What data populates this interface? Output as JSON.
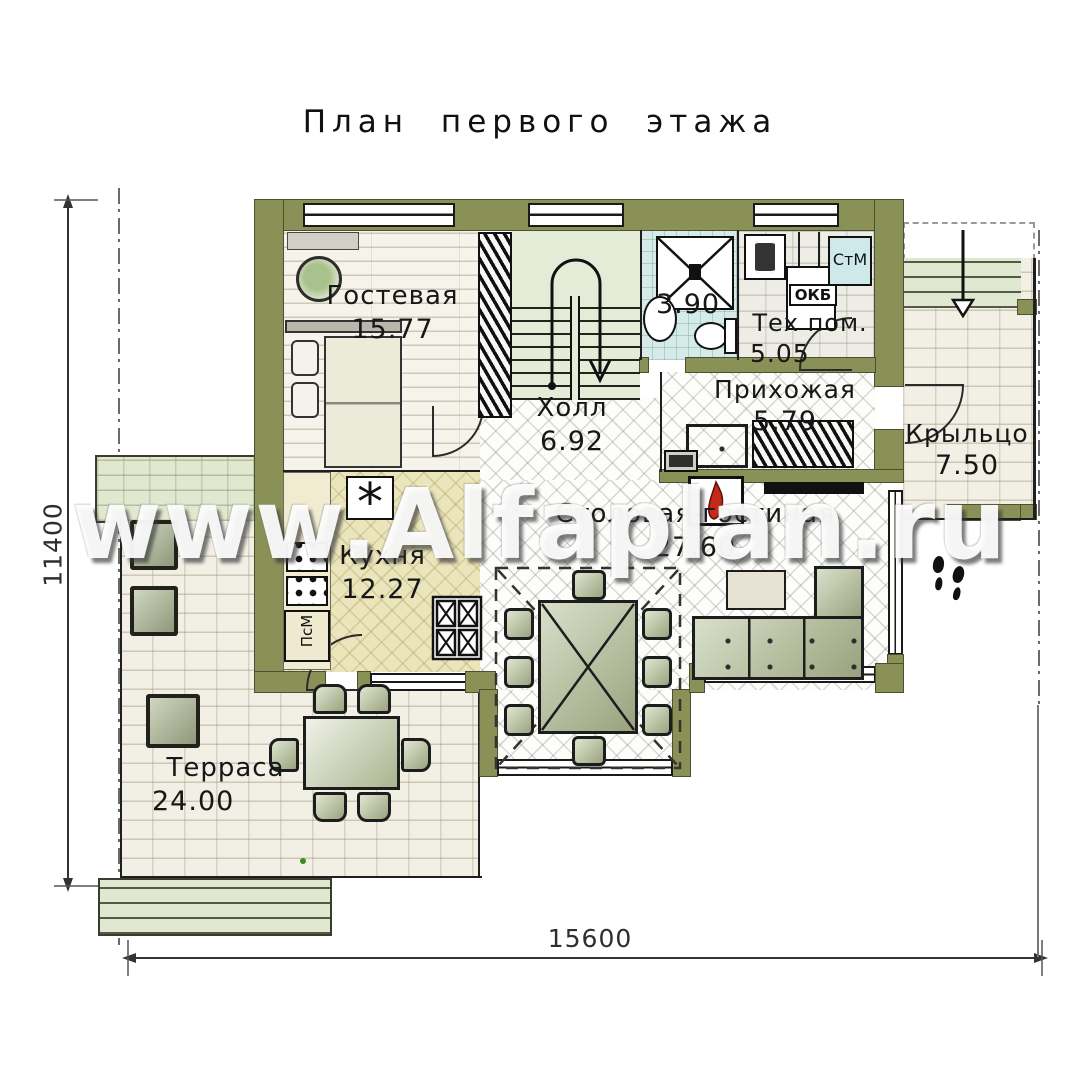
{
  "title": "План первого этажа",
  "watermark": "www.Alfaplan.ru",
  "dimensions": {
    "height_mm": "11400",
    "width_mm": "15600"
  },
  "rooms": {
    "guest": {
      "name": "Гостевая",
      "area": "15.77"
    },
    "hall": {
      "name": "Холл",
      "area": "6.92"
    },
    "bathroom": {
      "area": "3.90"
    },
    "tech": {
      "name": "Тех пом.",
      "area": "5.05"
    },
    "entry": {
      "name": "Прихожая",
      "area": "5.79"
    },
    "porch": {
      "name": "Крыльцо",
      "area": "7.50"
    },
    "kitchen": {
      "name": "Кухня",
      "area": "12.27"
    },
    "living": {
      "name": "Столовая-гостиная",
      "area": "27.60"
    },
    "terrace": {
      "name": "Терраса",
      "area": "24.00"
    }
  },
  "labels": {
    "washing_machine": "СтМ",
    "boiler": "ОКБ",
    "dishwasher": "ПсМ"
  },
  "icons": {
    "cooktop": "*"
  },
  "colors": {
    "wall_olive": "#8a9157",
    "flame_red": "#c52a18",
    "sofa_sage": "#aeb690",
    "bath_blue": "#d6eae8",
    "kitchen_cream": "#ebe5bc",
    "stairs_green": "#e4ecd7"
  }
}
